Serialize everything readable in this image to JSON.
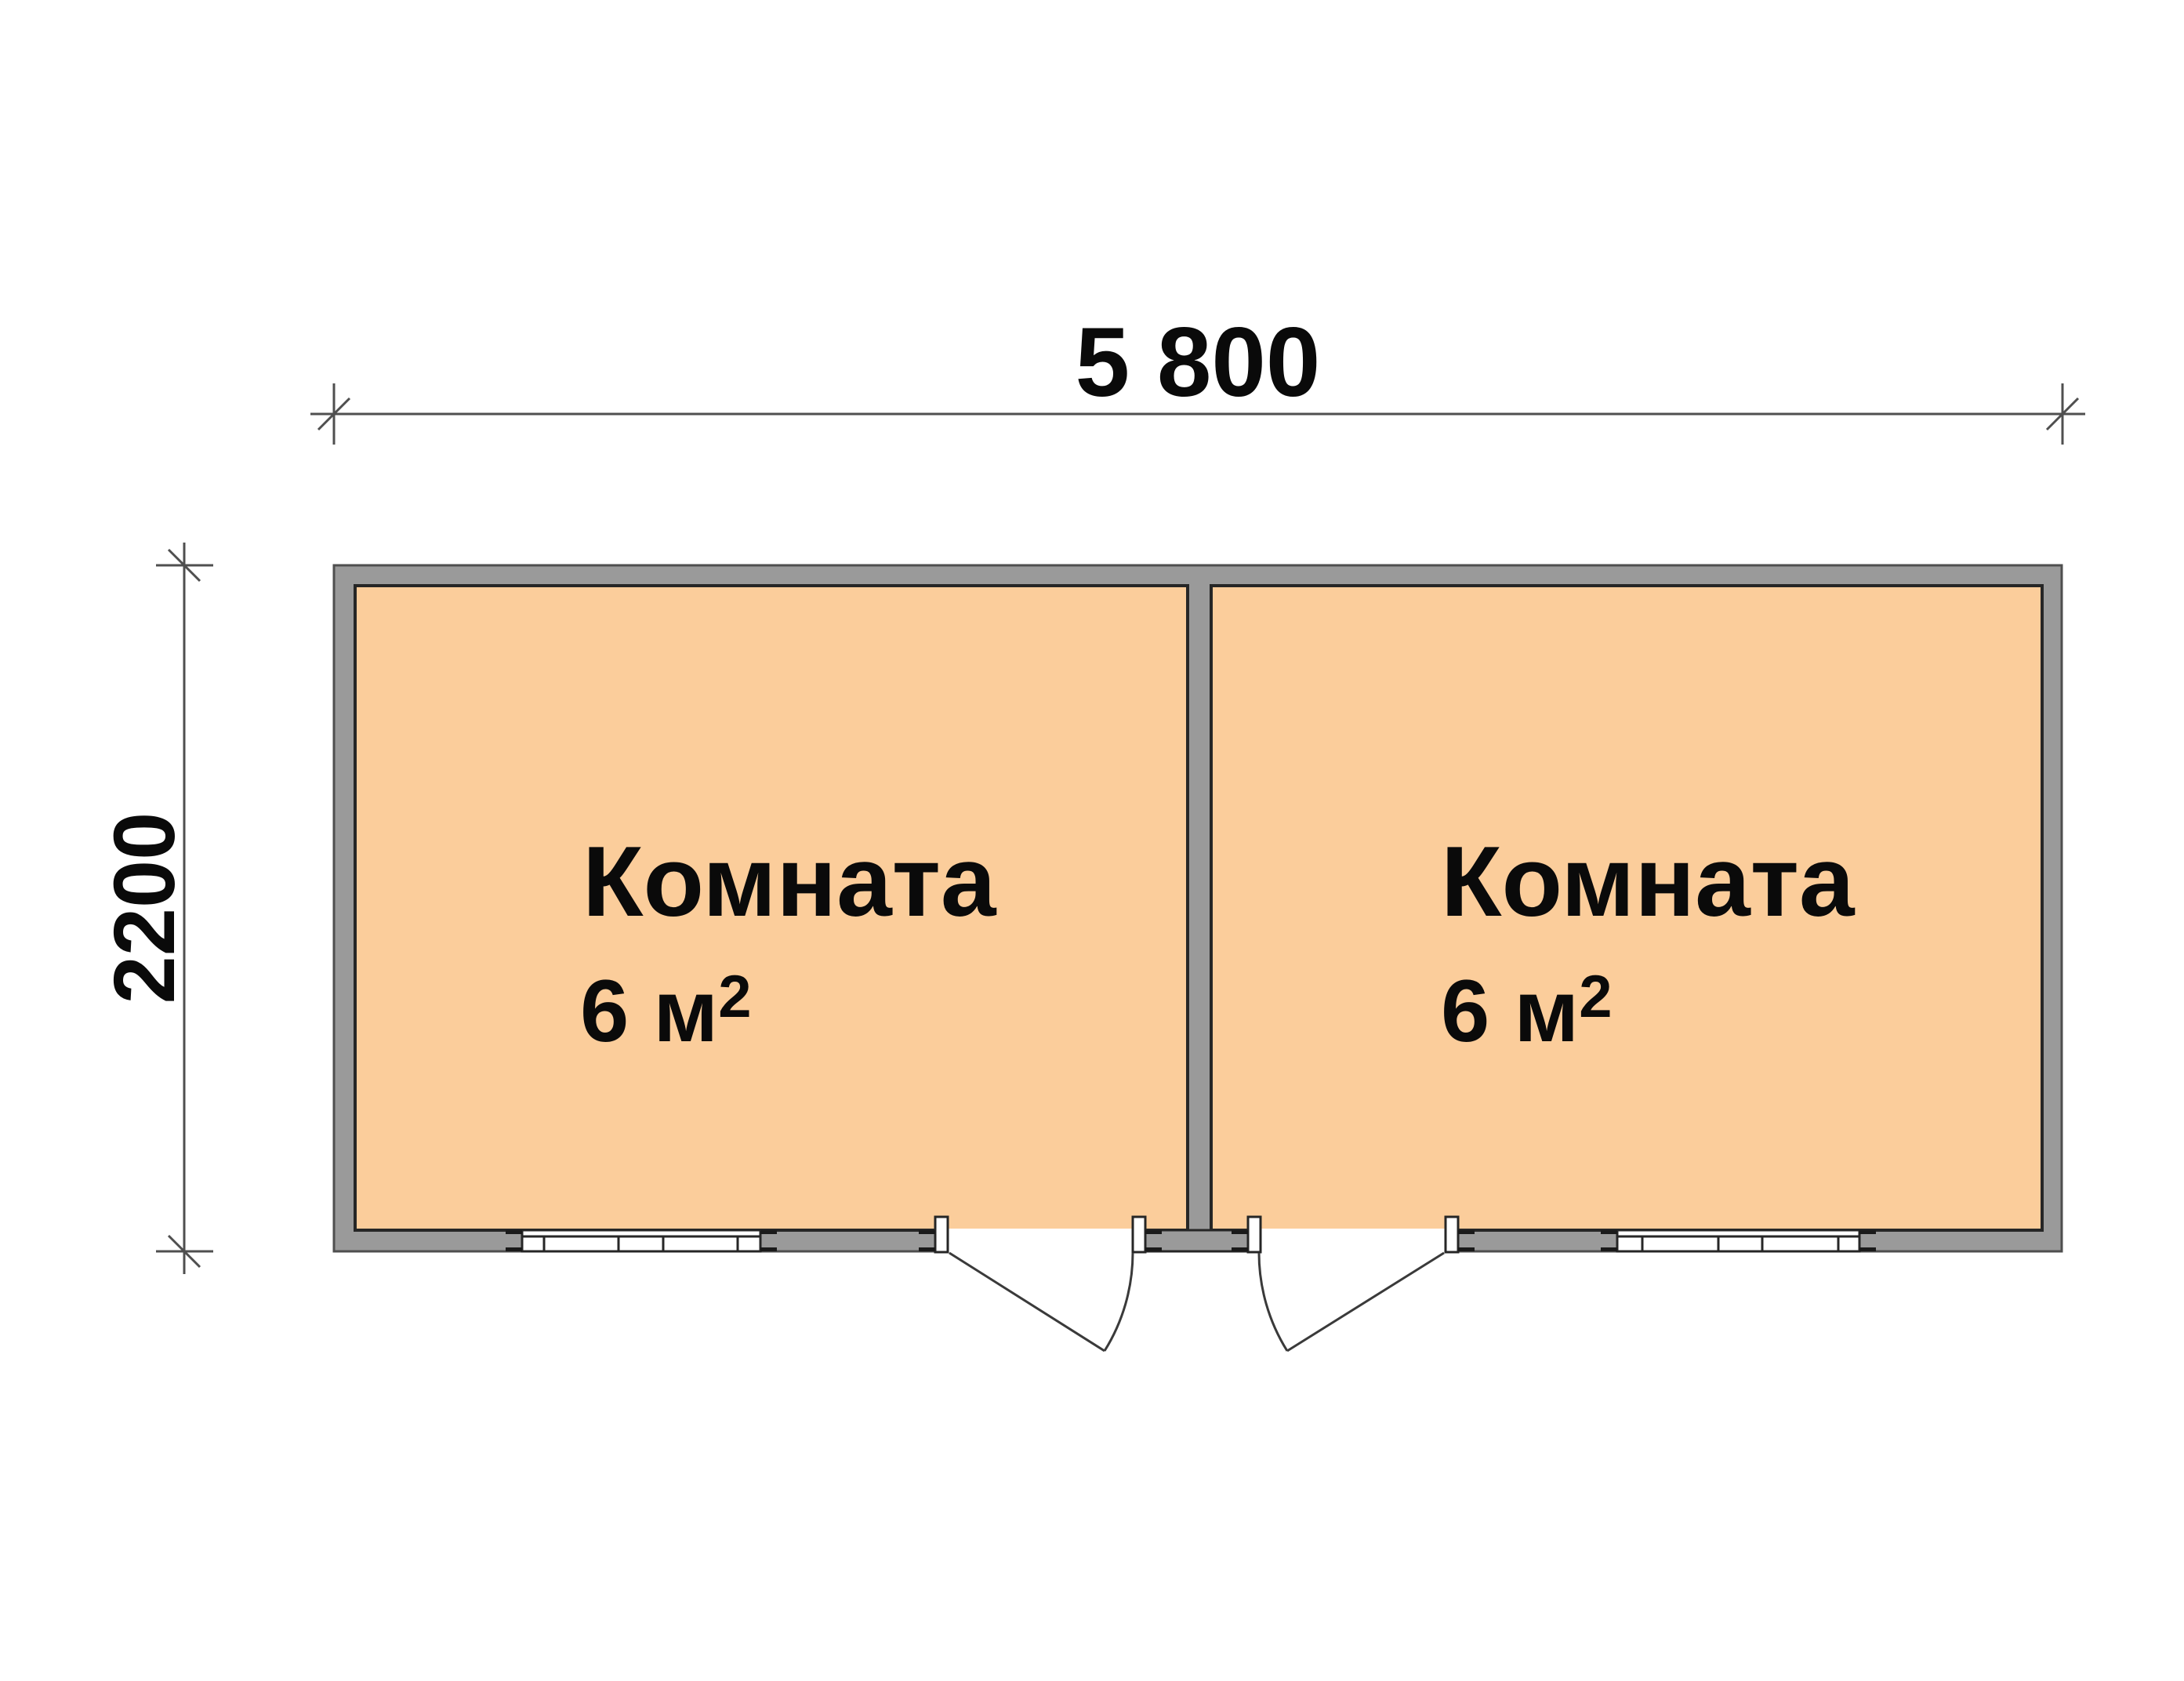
{
  "plan": {
    "dimensions": {
      "width_label": "5 800",
      "height_label": "2200"
    },
    "rooms": [
      {
        "name": "Комната",
        "area_value": "6 м",
        "area_superscript": "2"
      },
      {
        "name": "Комната",
        "area_value": "6 м",
        "area_superscript": "2"
      }
    ],
    "colors": {
      "wall": "#9a9a9a",
      "room_fill": "#fbcd9b",
      "outline": "#262626",
      "dim": "#4f4f4f"
    }
  }
}
